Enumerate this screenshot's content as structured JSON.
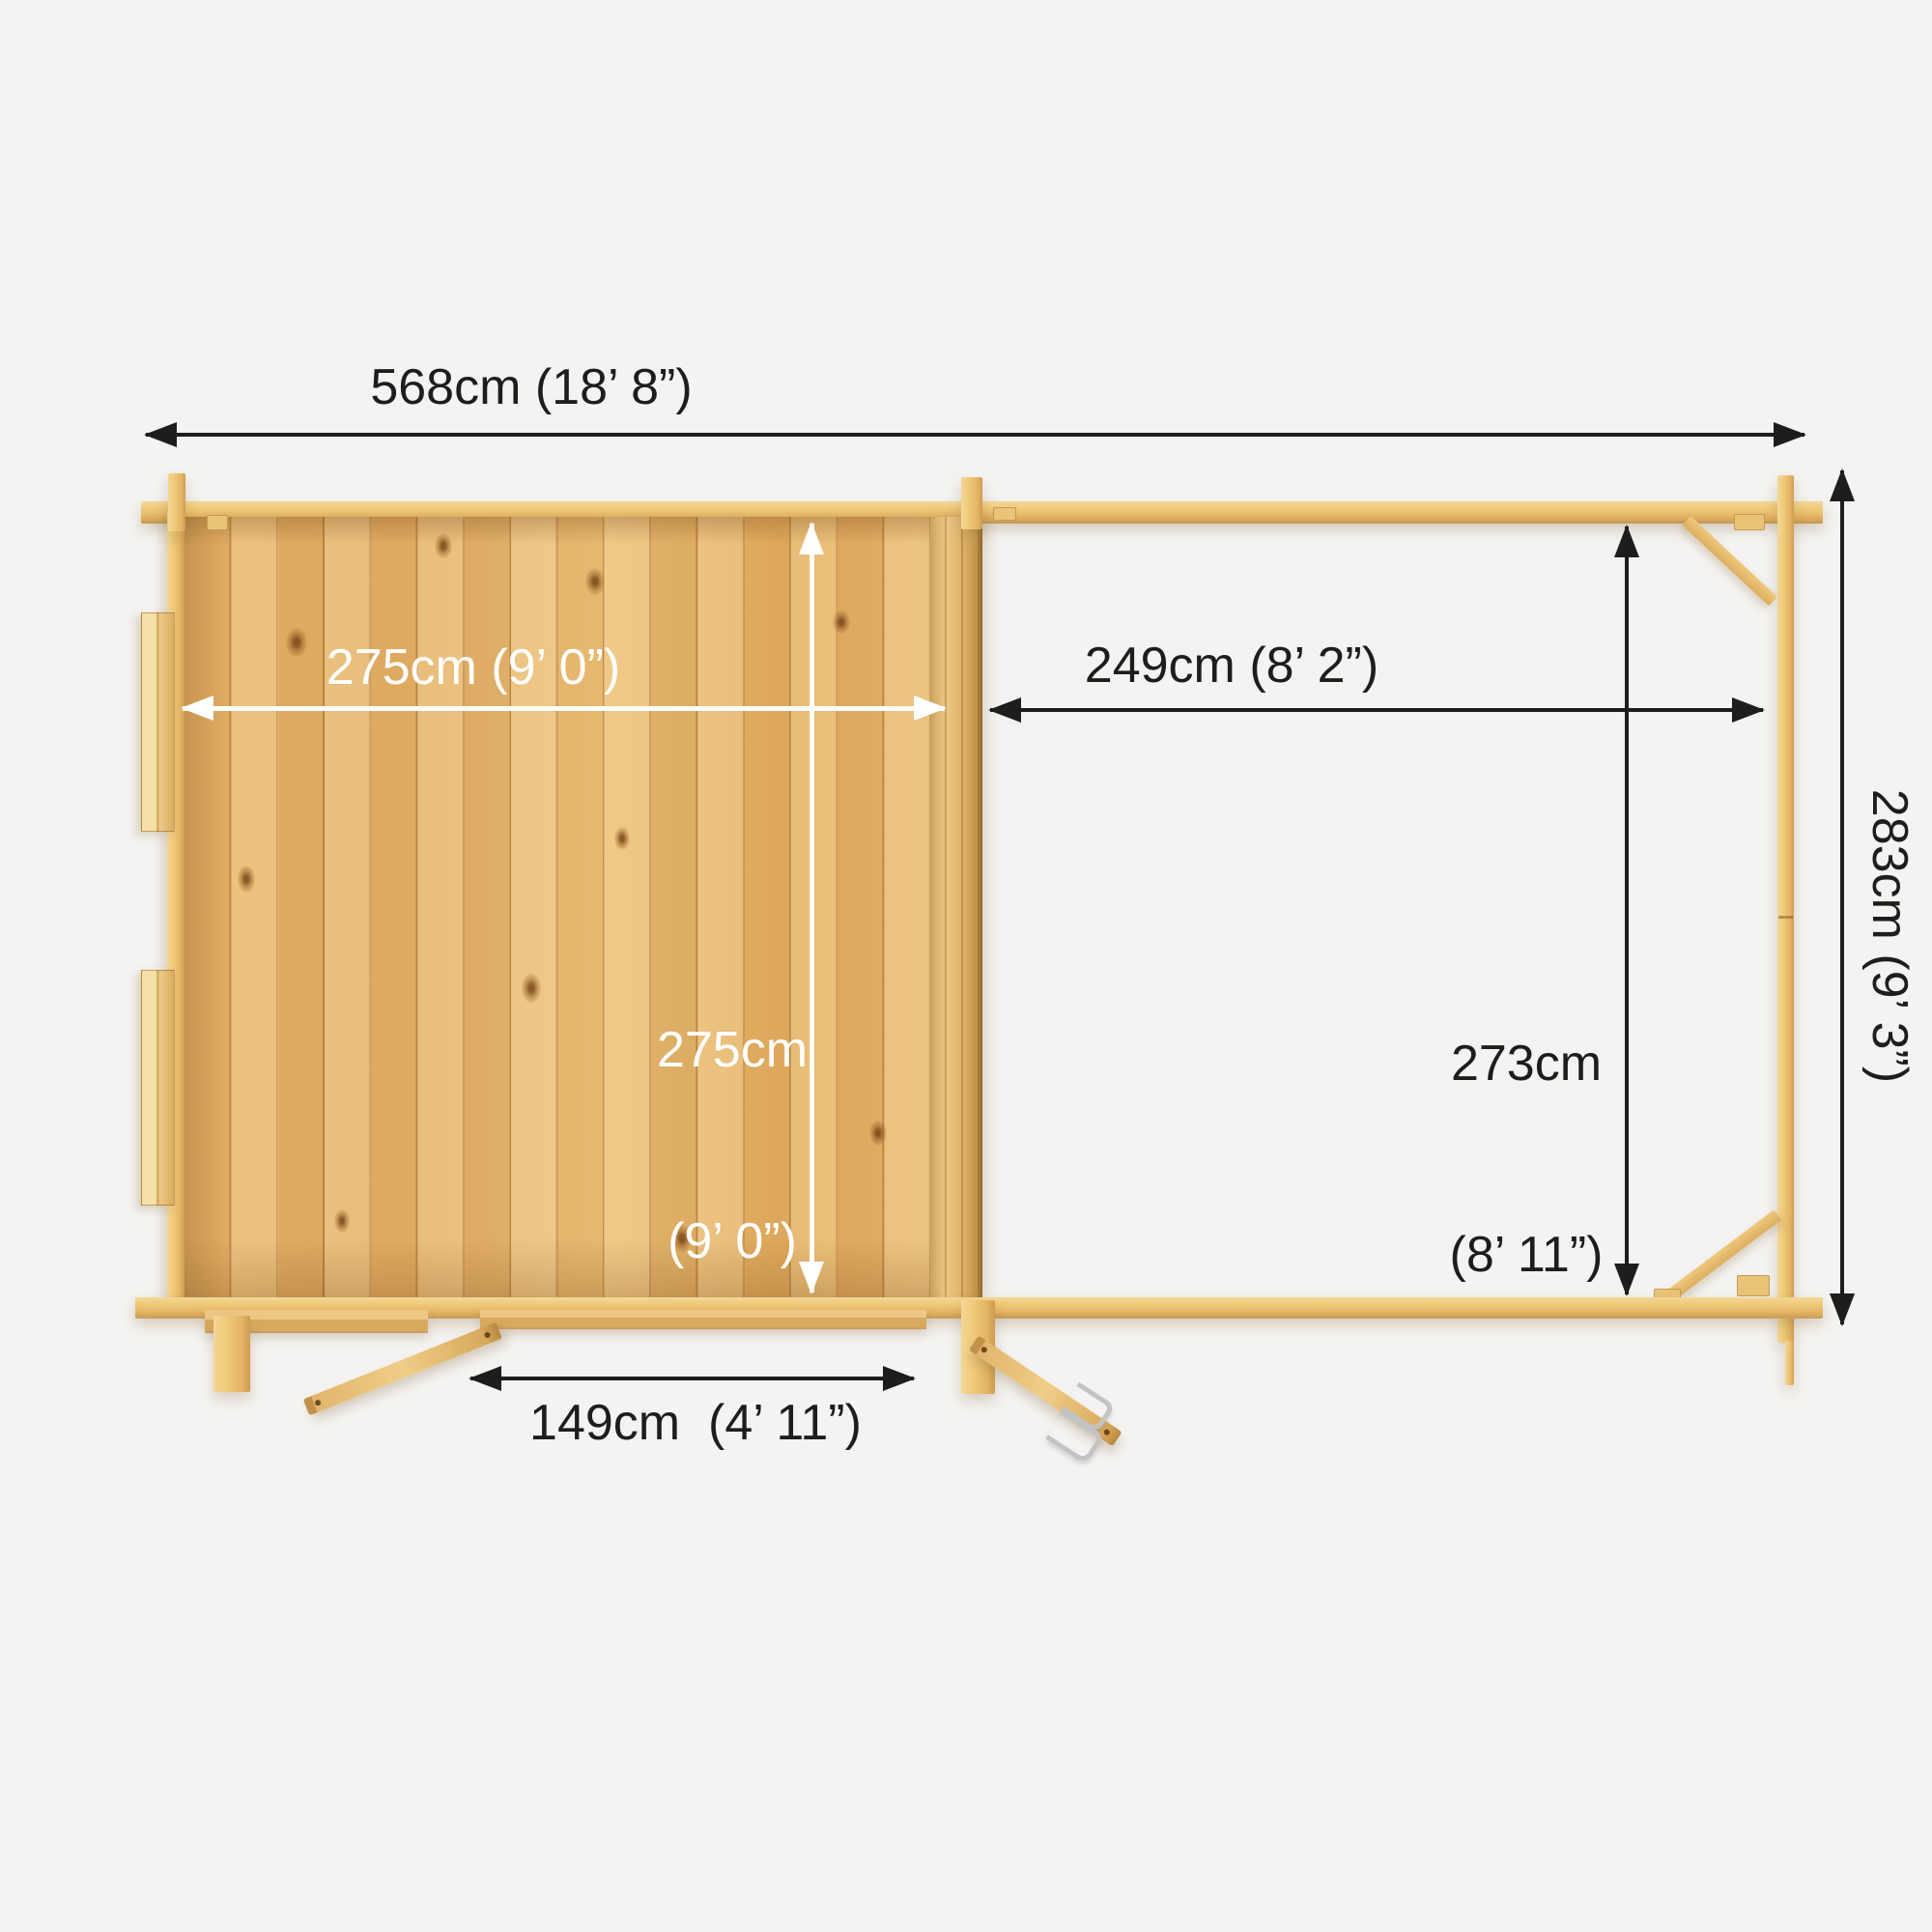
{
  "title": "Log cabin with side veranda — top view dimension plan",
  "colors": {
    "bg": "#f4f3f1",
    "arrow_black": "#1d1d1b",
    "arrow_white": "#ffffff",
    "text_dark": "#1d1d1b",
    "text_white": "#ffffff",
    "wood_beam": "#eac373",
    "wood_floor": "#e3b069",
    "wood_shadow": "#8b561c",
    "hook_silver": "#c3c3c3"
  },
  "dimensions": {
    "overall_width": "568cm (18’ 8”)",
    "cabin_width": "275cm (9’ 0”)",
    "cabin_depth_line1": "275cm",
    "cabin_depth_line2": "(9’ 0”)",
    "veranda_width": "249cm (8’ 2”)",
    "veranda_depth_line1": "273cm",
    "veranda_depth_line2": "(8’ 11”)",
    "overall_depth": "283cm (9’ 3”)",
    "door_opening": "149cm  (4’ 11”)"
  }
}
